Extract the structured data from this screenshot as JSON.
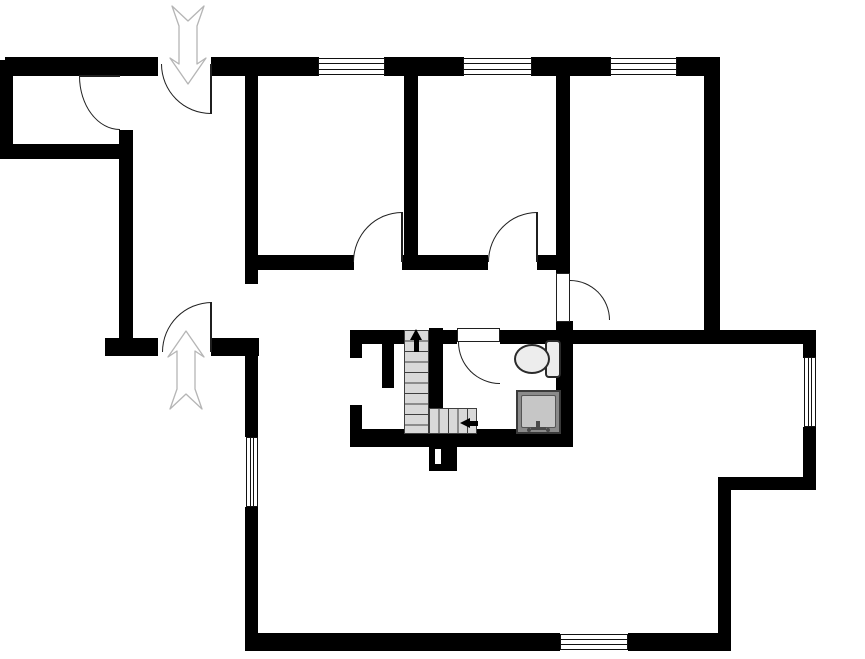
{
  "floorplan": {
    "canvas": {
      "width": 865,
      "height": 659,
      "background": "#ffffff"
    },
    "colors": {
      "wall": "#000000",
      "door_line": "#1f1f1f",
      "window_line": "#111111",
      "stair_fill": "#d9d9d9",
      "stair_line": "#3f3f3f",
      "arrow_fill": "#ffffff",
      "arrow_stroke": "#b5b5b5",
      "fixture_fill": "#ededed",
      "fixture_outline": "#2b2b2b",
      "shower_outer": "#8a8a8a",
      "shower_inner": "#c6c6c6"
    },
    "walls": [
      [
        5,
        57,
        153,
        19
      ],
      [
        211,
        57,
        108,
        19
      ],
      [
        384,
        57,
        80,
        19
      ],
      [
        531,
        57,
        80,
        19
      ],
      [
        676,
        57,
        44,
        19
      ],
      [
        0,
        60,
        13,
        99
      ],
      [
        0,
        144,
        133,
        15
      ],
      [
        119,
        130,
        14,
        226
      ],
      [
        105,
        338,
        53,
        18
      ],
      [
        211,
        338,
        48,
        18
      ],
      [
        245,
        57,
        13,
        227
      ],
      [
        245,
        255,
        109,
        15
      ],
      [
        402,
        255,
        86,
        15
      ],
      [
        537,
        255,
        33,
        15
      ],
      [
        404,
        57,
        14,
        200
      ],
      [
        556,
        57,
        14,
        217
      ],
      [
        556,
        321,
        17,
        126
      ],
      [
        704,
        57,
        16,
        287
      ],
      [
        500,
        330,
        316,
        14
      ],
      [
        350,
        330,
        54,
        14
      ],
      [
        443,
        330,
        14,
        14
      ],
      [
        429,
        328,
        14,
        81
      ],
      [
        350,
        344,
        12,
        14
      ],
      [
        350,
        405,
        12,
        36
      ],
      [
        382,
        344,
        12,
        44
      ],
      [
        350,
        429,
        223,
        18
      ],
      [
        803,
        330,
        13,
        28
      ],
      [
        803,
        427,
        13,
        63
      ],
      [
        718,
        477,
        98,
        13
      ],
      [
        718,
        477,
        13,
        174
      ],
      [
        245,
        633,
        315,
        18
      ],
      [
        628,
        633,
        103,
        18
      ],
      [
        245,
        338,
        13,
        99
      ],
      [
        245,
        507,
        13,
        144
      ]
    ],
    "chimney": {
      "body": [
        429,
        447,
        28,
        24
      ],
      "slot": [
        435,
        449,
        6,
        15
      ]
    },
    "windows": [
      {
        "r": [
          318,
          58,
          67,
          17
        ],
        "o": "h"
      },
      {
        "r": [
          463,
          58,
          69,
          17
        ],
        "o": "h"
      },
      {
        "r": [
          610,
          58,
          67,
          17
        ],
        "o": "h"
      },
      {
        "r": [
          246,
          437,
          12,
          70
        ],
        "o": "v"
      },
      {
        "r": [
          804,
          357,
          12,
          70
        ],
        "o": "v"
      },
      {
        "r": [
          560,
          634,
          68,
          16
        ],
        "o": "h"
      }
    ],
    "doors": [
      {
        "name": "storage-room-door",
        "arc": [
          79,
          76,
          41,
          54
        ],
        "corner": "bl",
        "leaf": [
          79,
          75,
          41,
          2
        ],
        "leaf_type": "line"
      },
      {
        "name": "main-entrance-door",
        "arc": [
          161,
          64,
          50,
          50
        ],
        "corner": "bl",
        "leaf": [
          210,
          64,
          2,
          50
        ],
        "leaf_type": "line"
      },
      {
        "name": "rear-entrance-door",
        "arc": [
          162,
          302,
          50,
          50
        ],
        "corner": "tl",
        "leaf": [
          210,
          302,
          2,
          50
        ],
        "leaf_type": "line"
      },
      {
        "name": "bedroom-1-door",
        "arc": [
          353,
          212,
          49,
          50
        ],
        "corner": "tl",
        "leaf": [
          401,
          212,
          2,
          50
        ],
        "leaf_type": "line"
      },
      {
        "name": "bedroom-2-door",
        "arc": [
          488,
          212,
          49,
          50
        ],
        "corner": "tl",
        "leaf": [
          536,
          212,
          2,
          50
        ],
        "leaf_type": "line"
      },
      {
        "name": "bedroom-3-door",
        "arc": [
          570,
          280,
          40,
          40
        ],
        "corner": "tr",
        "leaf": [
          556,
          273,
          14,
          49
        ],
        "leaf_type": "panel"
      },
      {
        "name": "bathroom-door",
        "arc": [
          458,
          342,
          42,
          42
        ],
        "corner": "bl",
        "leaf": [
          457,
          328,
          43,
          14
        ],
        "leaf_type": "panel"
      }
    ],
    "stairs": {
      "flights": [
        {
          "r": [
            404,
            330,
            25,
            104
          ],
          "o": "v"
        },
        {
          "r": [
            429,
            408,
            48,
            26
          ],
          "o": "h"
        }
      ],
      "up_arrow": {
        "shaft": [
          414,
          340,
          5,
          12
        ],
        "head": [
          410,
          329
        ]
      },
      "left_arrow": {
        "shaft": [
          469,
          421,
          9,
          5
        ],
        "head": [
          460,
          418
        ]
      }
    },
    "fixtures": {
      "toilet": {
        "bowl": [
          514,
          344,
          36,
          30
        ],
        "tank": [
          545,
          340,
          16,
          38
        ]
      },
      "shower": {
        "outer": [
          516,
          390,
          45,
          44
        ],
        "inner": [
          521,
          395,
          35,
          33
        ],
        "bar": [
          531,
          427,
          15,
          3
        ],
        "stem": [
          536,
          421,
          4,
          7
        ],
        "dots": [
          [
            527,
            428,
            4,
            4
          ],
          [
            546,
            428,
            4,
            4
          ]
        ]
      }
    },
    "entrance_arrows": [
      {
        "name": "entrance-arrow-down",
        "points": "188,84 170,58 179,64 179,26 172,6 188,21 204,6 197,26 197,64 206,58"
      },
      {
        "name": "entrance-arrow-up",
        "points": "186,331 204,357 195,351 195,389 202,409 186,394 170,409 177,389 177,351 168,357"
      }
    ]
  }
}
